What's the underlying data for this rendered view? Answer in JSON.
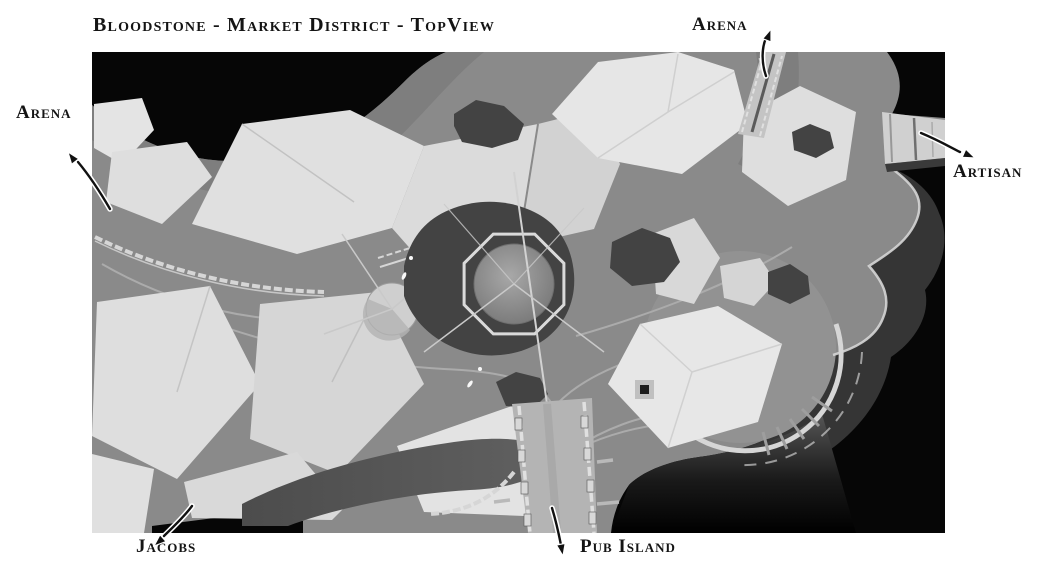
{
  "title": "Bloodstone - Market District - TopView",
  "annotations": {
    "arena_top": "Arena",
    "arena_left": "Arena",
    "artisan": "Artisan",
    "jacobs": "Jacobs",
    "pub_island": "Pub Island"
  },
  "colors": {
    "page_background": "#ffffff",
    "ink": "#141414",
    "map_background": "#060606",
    "terrain": "#8a8a8a",
    "roof_light": "#e0e0e0",
    "rock_dark": "#434343",
    "water_shade": "#353535",
    "road_line": "#aeaeae",
    "fence_light": "#d6d6d6"
  }
}
